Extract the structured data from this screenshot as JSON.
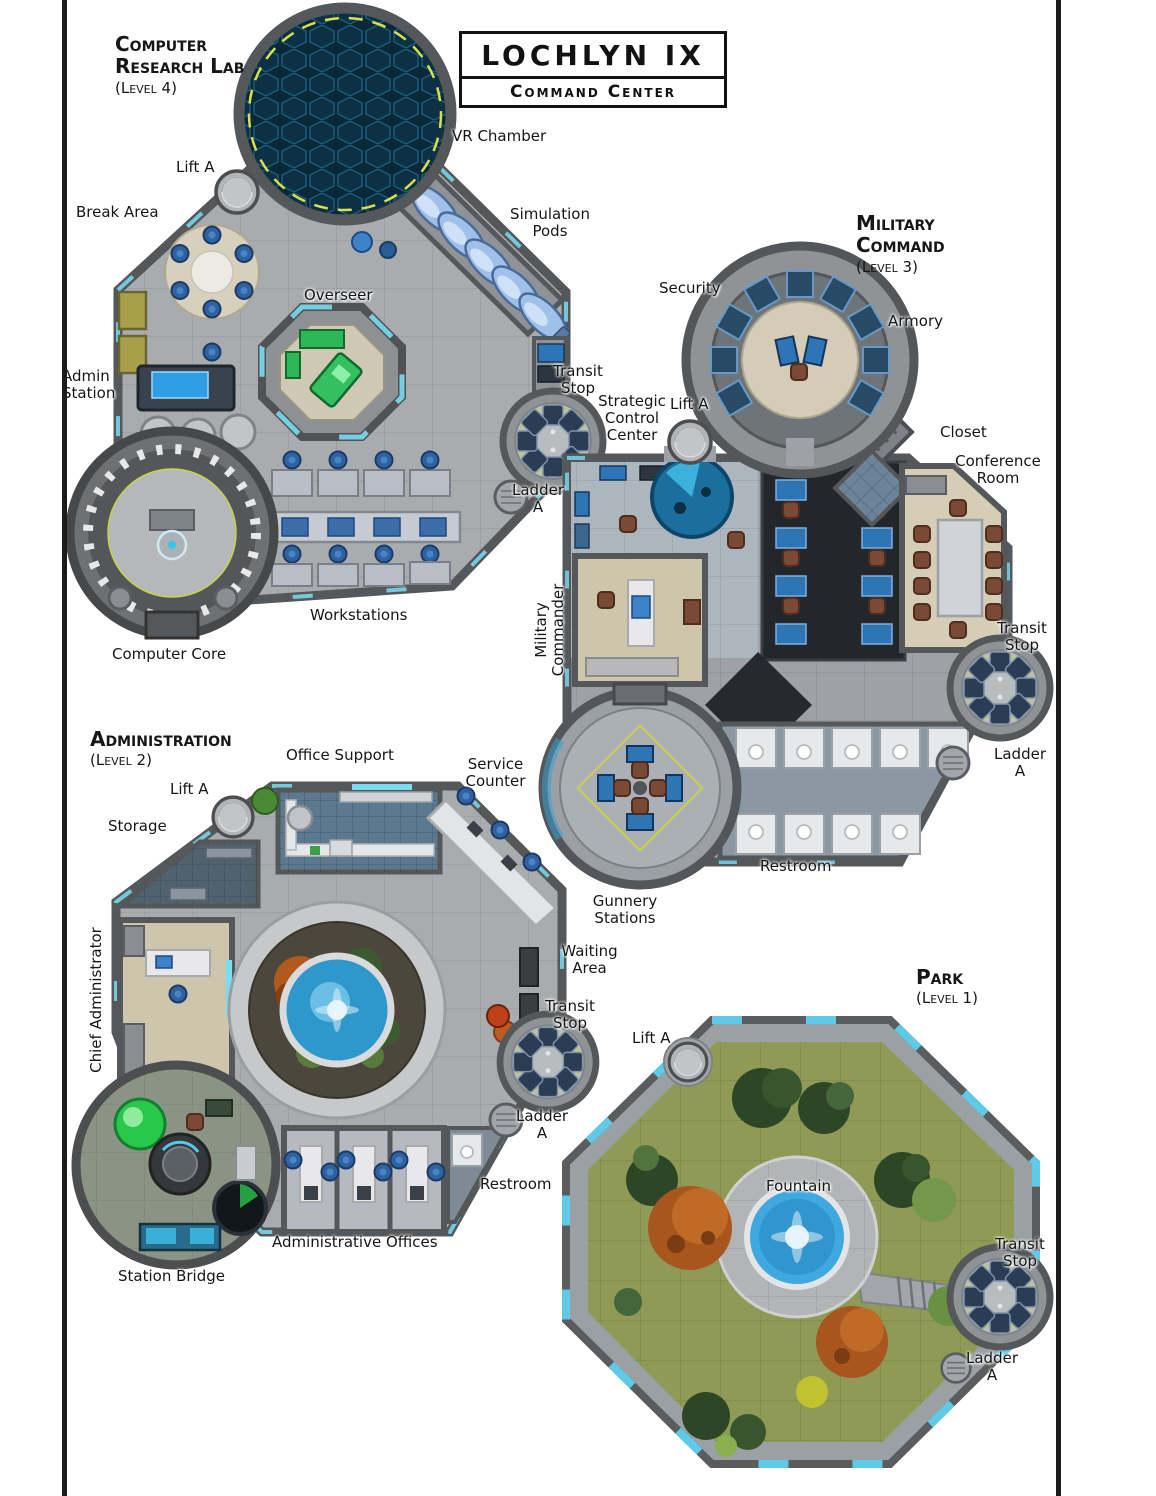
{
  "page": {
    "background": "#ffffff",
    "frame_color": "#1b1b1b"
  },
  "title": {
    "main": "LOCHLYN IX",
    "subtitle": "Command Center"
  },
  "colors": {
    "wall": "#55585a",
    "floor_gray": "#a9acaf",
    "accent_cyan": "#7adcf2",
    "accent_yellow": "#e8e33a",
    "water_blue": "#3fa8de",
    "grass_green": "#8e9a56",
    "chair_blue": "#2f62a0",
    "room_beige": "#cdc5ac",
    "vr_hex_blue": "#0d3144"
  },
  "levels": [
    {
      "id": "computer-research-lab",
      "name": "Computer Research Lab",
      "level": "(Level 4)",
      "labels": {
        "vr_chamber": "VR Chamber",
        "lift": "Lift A",
        "break_area": "Break Area",
        "simulation_pods": "Simulation Pods",
        "overseer": "Overseer",
        "admin_station": "Admin Station",
        "transit_stop": "Transit Stop",
        "ladder": "Ladder A",
        "workstations": "Workstations",
        "computer_core": "Computer Core"
      }
    },
    {
      "id": "military-command",
      "name": "Military Command",
      "level": "(Level 3)",
      "labels": {
        "security": "Security",
        "armory": "Armory",
        "lift": "Lift A",
        "strategic_control_center": "Strategic Control Center",
        "closet": "Closet",
        "conference_room": "Conference Room",
        "military_commander": "Military Commander",
        "transit_stop": "Transit Stop",
        "ladder": "Ladder A",
        "restroom": "Restroom",
        "gunnery_stations": "Gunnery Stations"
      }
    },
    {
      "id": "administration",
      "name": "Administration",
      "level": "(Level 2)",
      "labels": {
        "office_support": "Office Support",
        "service_counter": "Service Counter",
        "lift": "Lift A",
        "storage": "Storage",
        "chief_administrator": "Chief Administrator",
        "waiting_area": "Waiting Area",
        "transit_stop": "Transit Stop",
        "ladder": "Ladder A",
        "restroom": "Restroom",
        "administrative_offices": "Administrative Offices",
        "station_bridge": "Station Bridge"
      }
    },
    {
      "id": "park",
      "name": "Park",
      "level": "(Level 1)",
      "labels": {
        "lift": "Lift A",
        "fountain": "Fountain",
        "transit_stop": "Transit Stop",
        "ladder": "Ladder A"
      }
    }
  ]
}
